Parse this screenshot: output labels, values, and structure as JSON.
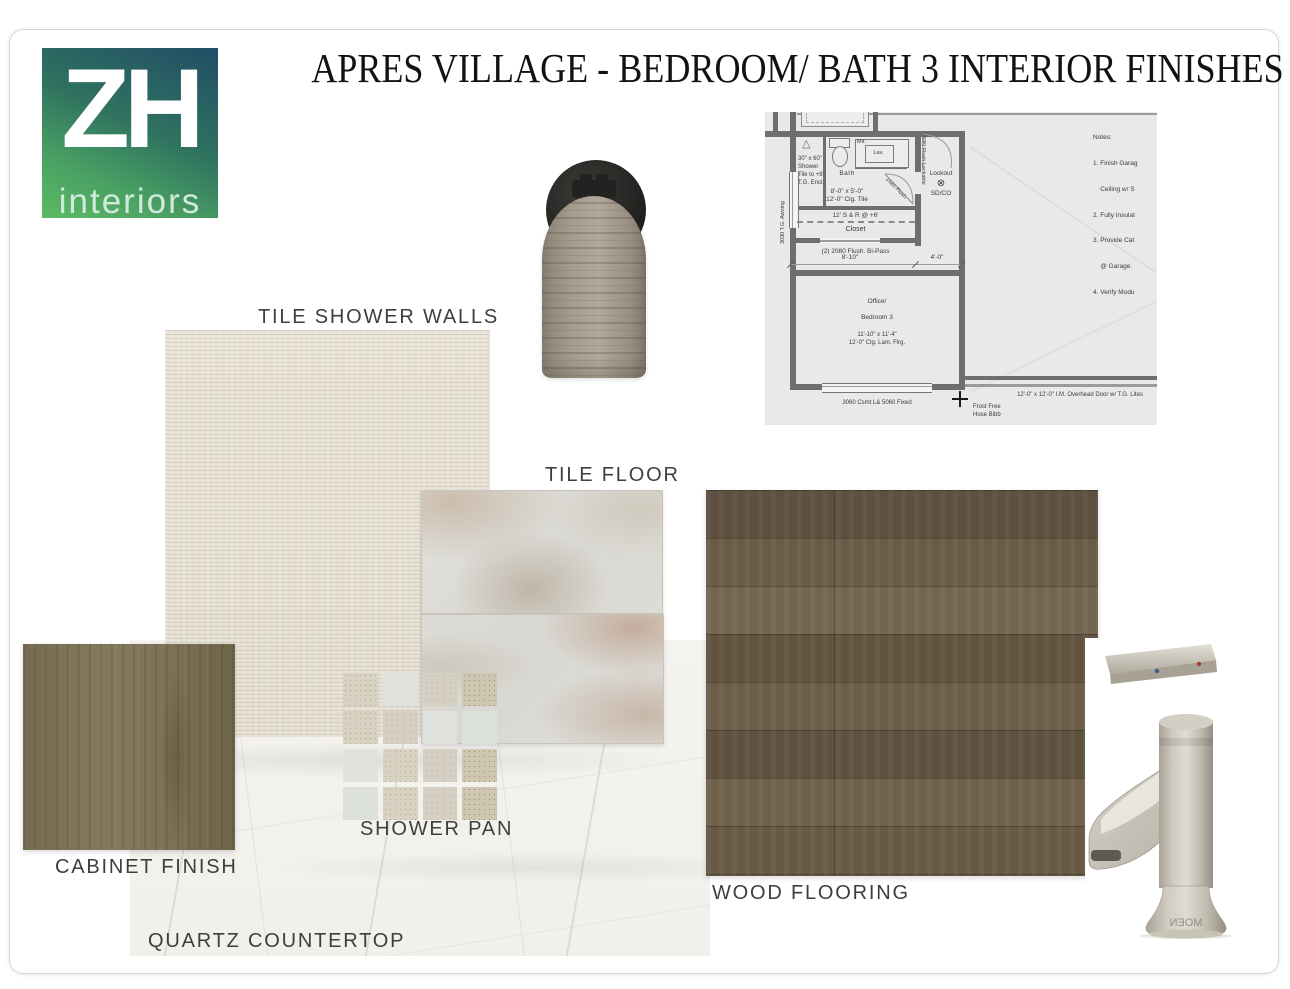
{
  "board": {
    "title": "APRES VILLAGE - BEDROOM/ BATH 3 INTERIOR FINISHES"
  },
  "logo": {
    "monogram": "ZH",
    "wordmark": "interiors"
  },
  "labels": {
    "tile_shower_walls": "TILE SHOWER WALLS",
    "tile_floor": "TILE FLOOR",
    "cabinet_finish": "CABINET FINISH",
    "shower_pan": "SHOWER PAN",
    "quartz_countertop": "QUARTZ COUNTERTOP",
    "wood_flooring": "WOOD FLOORING"
  },
  "colors": {
    "logo_gradient_top": "#214d66",
    "logo_gradient_bottom": "#5eba64",
    "shower_wall_tile": "#e8e2d7",
    "tile_floor_base": "#dedcd6",
    "cabinet_wood": "#7d7358",
    "wood_floor": "#6b5c47",
    "quartz_base": "#f4f3ef",
    "nickel": "#c9c4b8",
    "label_text": "#3e3e3e"
  },
  "plan": {
    "bath_name": "Bath",
    "bath_size": "8'-0\" x 5'-0\"",
    "bath_clg": "12'-0\" Clg. Tile",
    "shower_l1": "30\" x 60\"",
    "shower_l2": "Shower",
    "shower_l3": "Tile to +8'",
    "shower_l4": "T.G. Encl.",
    "mir": "Mir.",
    "lav": "Lav.",
    "lockout": "Lockout",
    "lockout_symbol": "⊗",
    "sdco": "SD/CO",
    "shelf": "12' S & R @ +6'",
    "closet": "Closet",
    "bipass": "(2) 2080 Flush. Bi-Pass",
    "dim_left": "8'-10\"",
    "dim_right": "4'-0\"",
    "office_l1": "Office/",
    "office_l2": "Bedroom 3",
    "office_size": "11'-10\" x 11'-4\"",
    "office_clg": "12'-0\" Clg. Lam. Flrg.",
    "window": "3060 Csmt L& 5060 Fixed",
    "awning": "3030 T.G. Awning",
    "bath_door": "2480 Flush",
    "lockout_door": "2680 Flush Lockable",
    "overhead": "12'-0\" x 12'-0\" I.M. Overhead Door w/ T.G. Lites",
    "hose1": "Frost Free",
    "hose2": "Hose Bibb",
    "notes": [
      "Notes:",
      "1. Finish Garag",
      "    Ceiling w/ S",
      "2. Fully Insulat",
      "3. Provide Cat",
      "    @ Garage.",
      "4. Verify Modu"
    ]
  },
  "faucet": {
    "brand": "MOEN"
  }
}
